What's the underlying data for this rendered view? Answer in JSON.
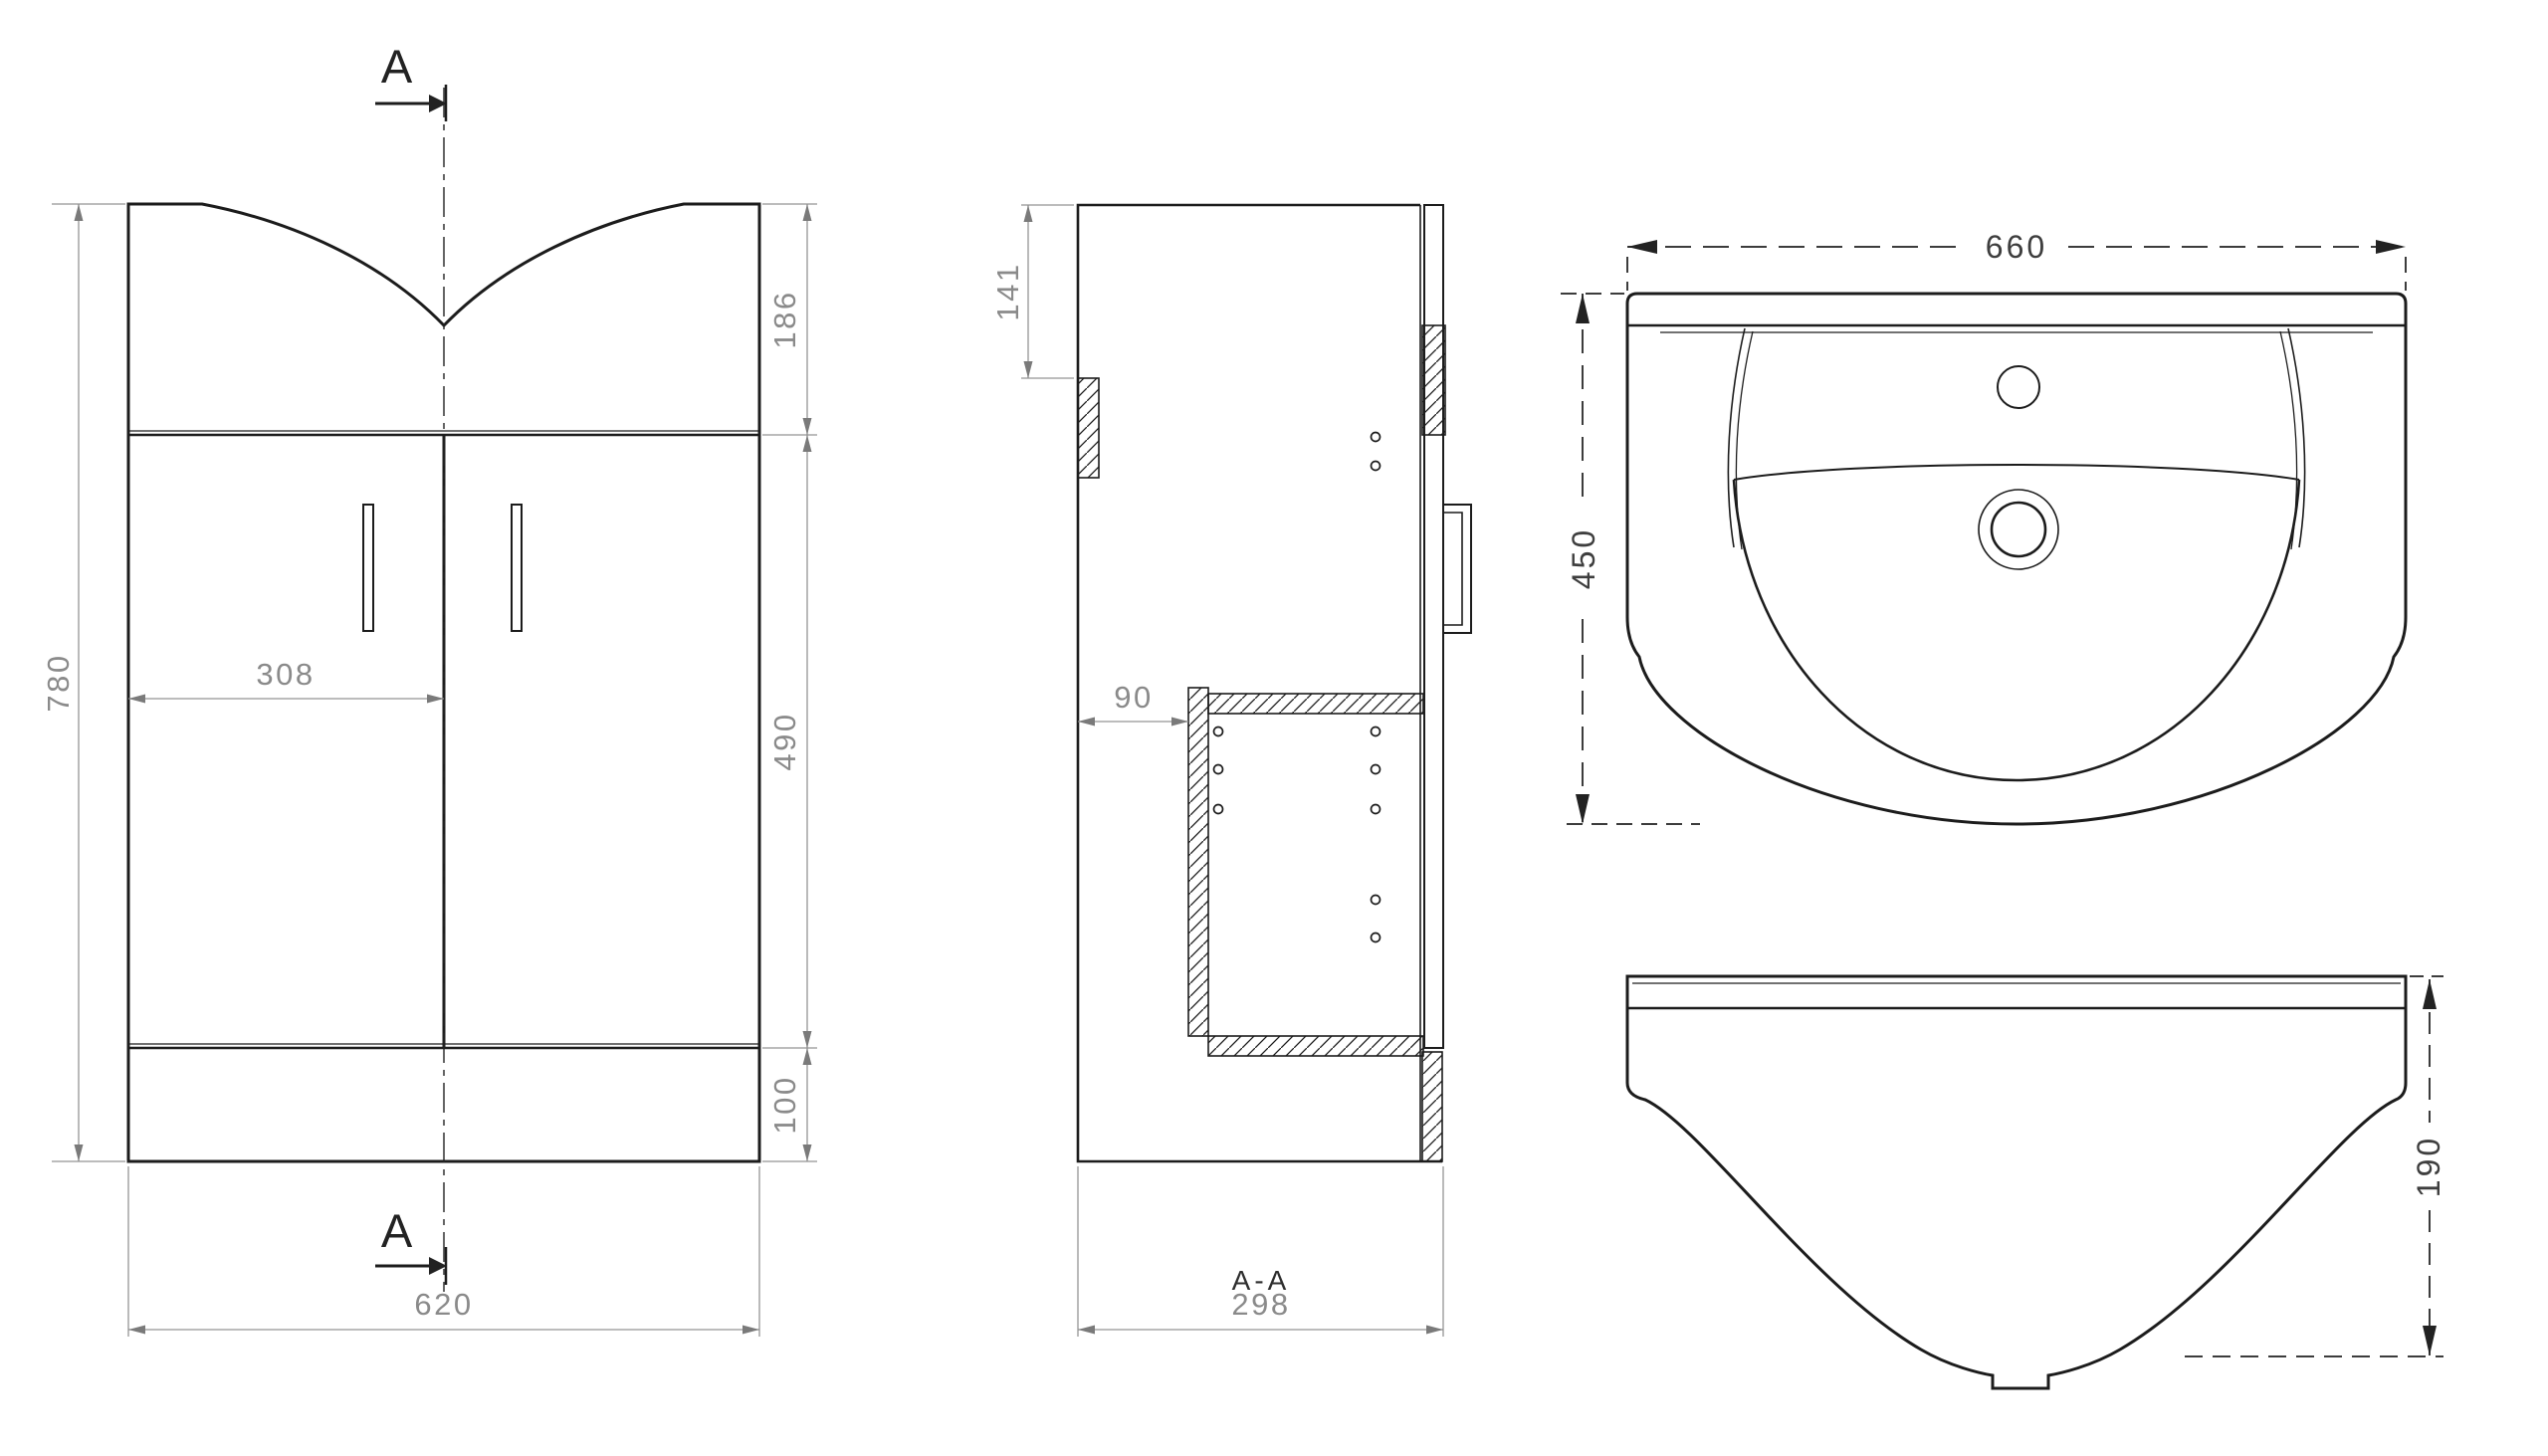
{
  "meta": {
    "background_color": "#ffffff",
    "line_color": "#1c1c1c",
    "dim_color": "#8a8a8a",
    "dim_dark_color": "#3e3e3e"
  },
  "front_view": {
    "marker_top": "A",
    "marker_bottom": "A",
    "dim_height": "780",
    "dim_width": "620",
    "dim_door_width": "308",
    "dim_top_section": "186",
    "dim_door_section": "490",
    "dim_plinth": "100"
  },
  "section_view": {
    "title": "A-A",
    "dim_depth": "298",
    "dim_top_rail": "141",
    "dim_back_offset": "90"
  },
  "basin_plan": {
    "dim_width": "660",
    "dim_depth": "450"
  },
  "basin_front": {
    "dim_height": "190"
  }
}
